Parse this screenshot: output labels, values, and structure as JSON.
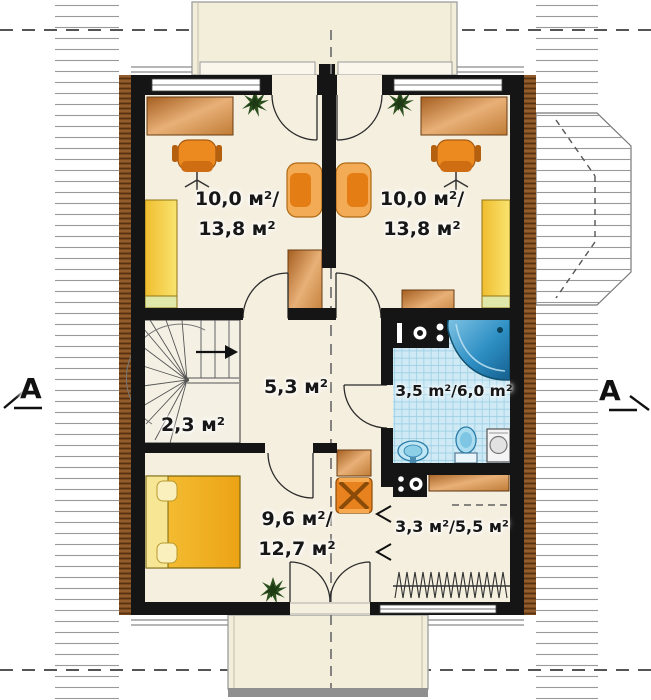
{
  "plan": {
    "title": "attic floor plan",
    "section_markers": {
      "left": "A",
      "right": "A"
    },
    "rooms": {
      "top_left": {
        "line1": "10,0 м²/",
        "line2": "13,8 м²"
      },
      "top_right": {
        "line1": "10,0 м²/",
        "line2": "13,8 м²"
      },
      "hall": {
        "label": "5,3 м²"
      },
      "stairs": {
        "label": "2,3 м²"
      },
      "bathroom": {
        "label": "3,5 m²/6,0 m²"
      },
      "bedroom": {
        "line1": "9,6 м²/",
        "line2": "12,7 м²"
      },
      "storage": {
        "label": "3,3 м²/5,5 м²"
      }
    },
    "colors": {
      "floor": "#f5efdf",
      "wall": "#151515",
      "roof_line": "#999999",
      "trim_brown": "#7a4a1e",
      "furniture_orange": "#e8821e",
      "copper_desk": "#c07c36",
      "wardrobe_yellow": "#f0bd2f",
      "bed_yellow": "#f2b52d",
      "bath_tile": "#cfeaf5",
      "tub_blue": "#2e8fc4",
      "plant_green": "#2d5020",
      "dormer_fill": "#f3eeda"
    },
    "furniture_icons": [
      "desk",
      "office-chair",
      "armchair",
      "wardrobe",
      "plant",
      "bed",
      "folding-chair",
      "corner-bathtub",
      "toilet",
      "washbasin",
      "washing-machine",
      "appliance-unit",
      "shelf",
      "clothes-rail",
      "winder-stairs"
    ]
  }
}
